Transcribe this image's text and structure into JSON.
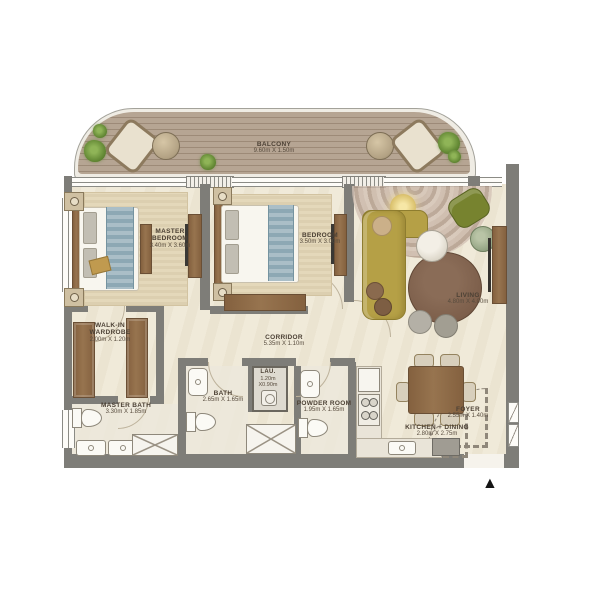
{
  "rooms": [
    {
      "id": "balcony",
      "name": "BALCONY",
      "dims": "9.60m X 1.50m"
    },
    {
      "id": "master-bedroom",
      "name": "MASTER BEDROOM",
      "dims": "3.40m X 3.60m"
    },
    {
      "id": "bedroom",
      "name": "BEDROOM",
      "dims": "3.50m X 3.00m"
    },
    {
      "id": "living",
      "name": "LIVING",
      "dims": "4.80m X 4.00m"
    },
    {
      "id": "walkin-wardrobe",
      "name": "WALK-IN WARDROBE",
      "dims": "2.00m X 1.20m"
    },
    {
      "id": "corridor",
      "name": "CORRIDOR",
      "dims": "5.35m X 1.10m"
    },
    {
      "id": "master-bath",
      "name": "MASTER BATH",
      "dims": "3.30m X 1.85m"
    },
    {
      "id": "bath",
      "name": "BATH",
      "dims": "2.65m X 1.65m"
    },
    {
      "id": "laundry",
      "name": "LAU.",
      "dims": "1.20m X0.90m"
    },
    {
      "id": "powder-room",
      "name": "POWDER ROOM",
      "dims": "1.95m X 1.65m"
    },
    {
      "id": "kitchen-dining",
      "name": "KITCHEN + DINING",
      "dims": "2.80m X 2.75m"
    },
    {
      "id": "foyer",
      "name": "FOYER",
      "dims": "2.55m X 1.40m"
    }
  ],
  "icons": {
    "entrance_marker": "▲"
  },
  "colors": {
    "wall": "#7e7d78",
    "floor": "#f0ead9",
    "deck": "#b6a593",
    "wood": "#8d6b4a",
    "sofa_olive": "#b5a046",
    "armchair_green": "#77832f",
    "bedding_blue": "#8da8b4",
    "round_rug_brown": "#7d5f4b",
    "label_text": "#4c4135"
  }
}
